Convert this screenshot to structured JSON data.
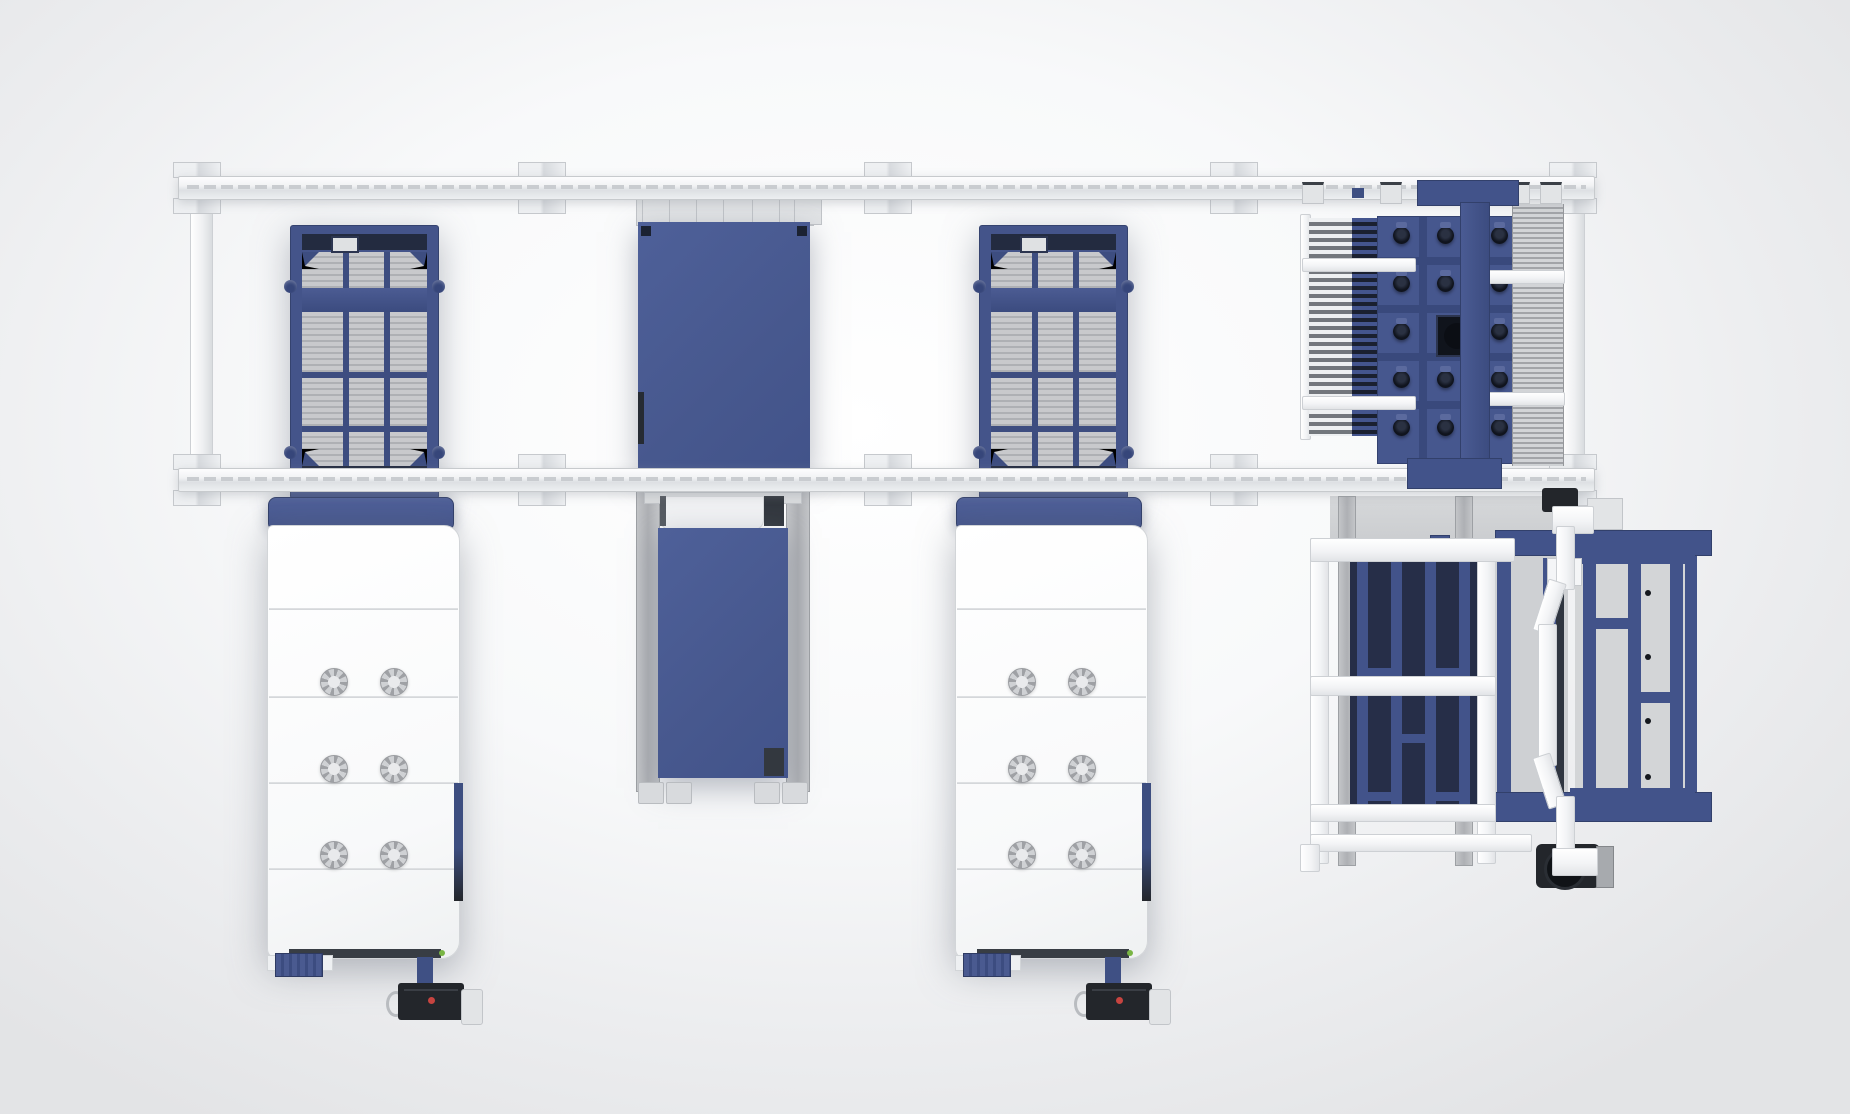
{
  "meta": {
    "type": "3d-render-top-view",
    "subject": "Top view of an industrial fiber-laser cutting system layout: two laser machines with slat-grid towers, overhead twin transfer rails, sheet shuttle and exchange table, rake-type unloading unit with suction-cup crossbeam, and automated pallet storage unit"
  },
  "palette": {
    "background_center": "#ffffff",
    "background_edge": "#e3e4e6",
    "rail_white": "#f4f5f7",
    "rail_border": "#c7cacd",
    "machine_blue": "#47588e",
    "frame_blue": "#42538a",
    "beam_blue_dark": "#39497c",
    "pallet_navy": "#262e48",
    "slat_grey_light": "#c8c9cc",
    "slat_grey_dark": "#aeb0b4",
    "panel_white": "#fcfcfd",
    "pendant_dark": "#23262b",
    "indicator_red": "#c74440",
    "indicator_green": "#79b544"
  },
  "components": {
    "gantry": {
      "rails": [
        "top transfer rail",
        "bottom transfer rail"
      ],
      "wall_bracket_pairs": 10,
      "end_posts": 2
    },
    "slat_grid_towers": {
      "count": 2,
      "grid_columns": 3,
      "grid_rows": 4
    },
    "sheet_shuttle": {
      "carriage_clamps": 4,
      "payload": "blue metal sheet",
      "corner_marks": 2
    },
    "laser_machines": {
      "count": 2,
      "body_panels": 5,
      "vents_per_machine": 6,
      "pendant": "hanging control pendant with red indicator",
      "status_led": "green"
    },
    "exchange_table": {
      "payload": "blue metal sheet",
      "feet": 4,
      "side_rails": 2
    },
    "unloading_unit": {
      "rake_comb_fields": 2,
      "suction_cup_rows": 5,
      "suction_cup_columns": 3,
      "crossbeam": "blue T-beam",
      "camera_box": 1,
      "white_crossbars": 4
    },
    "storage_unit": {
      "service_frame": "white ladder frame",
      "pallet": "navy pallet with blue ribs",
      "cart": "blue pallet cart with grey panels",
      "swing_arm": "white angular arm",
      "drive_motor": 1
    }
  }
}
